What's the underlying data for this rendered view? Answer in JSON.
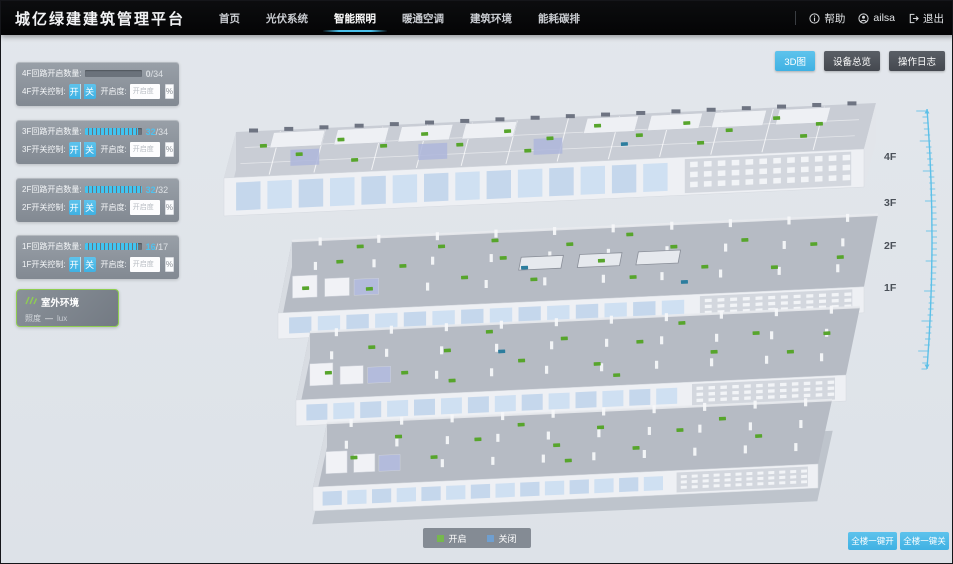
{
  "header": {
    "title": "城亿绿建建筑管理平台",
    "nav": [
      {
        "label": "首页",
        "active": false
      },
      {
        "label": "光伏系统",
        "active": false
      },
      {
        "label": "智能照明",
        "active": true
      },
      {
        "label": "暖通空调",
        "active": false
      },
      {
        "label": "建筑环境",
        "active": false
      },
      {
        "label": "能耗碳排",
        "active": false
      }
    ],
    "help": "帮助",
    "user": "ailsa",
    "logout": "退出"
  },
  "toolbar": {
    "view_3d": "3D图",
    "device_overview": "设备总览",
    "operation_log": "操作日志"
  },
  "floor_panels": [
    {
      "count_label": "4F回路开启数量:",
      "count": "0",
      "total": "/34",
      "progress_pct": 0,
      "count_color": "#d7dbdf",
      "switch_label": "4F开关控制:",
      "on_label": "开",
      "off_label": "关",
      "dim_label": "开启度:",
      "dim_placeholder": "开启度",
      "unit": "%"
    },
    {
      "count_label": "3F回路开启数量:",
      "count": "32",
      "total": "/34",
      "progress_pct": 94,
      "count_color": "#4fc1ee",
      "switch_label": "3F开关控制:",
      "on_label": "开",
      "off_label": "关",
      "dim_label": "开启度:",
      "dim_placeholder": "开启度",
      "unit": "%"
    },
    {
      "count_label": "2F回路开启数量:",
      "count": "32",
      "total": "/32",
      "progress_pct": 100,
      "count_color": "#4fc1ee",
      "switch_label": "2F开关控制:",
      "on_label": "开",
      "off_label": "关",
      "dim_label": "开启度:",
      "dim_placeholder": "开启度",
      "unit": "%"
    },
    {
      "count_label": "1F回路开启数量:",
      "count": "16",
      "total": "/17",
      "progress_pct": 94,
      "count_color": "#4fc1ee",
      "switch_label": "1F开关控制:",
      "on_label": "开",
      "off_label": "关",
      "dim_label": "开启度:",
      "dim_placeholder": "开启度",
      "unit": "%"
    }
  ],
  "outdoor": {
    "title": "室外环境",
    "metric_label": "照度",
    "metric_value": "—",
    "metric_unit": "lux"
  },
  "floor_labels": [
    "4F",
    "3F",
    "2F",
    "1F"
  ],
  "legend": {
    "on_label": "开启",
    "off_label": "关闭",
    "on_color": "#76b84e",
    "off_color": "#6f9fd0"
  },
  "bulk": {
    "all_on": "全楼一键开",
    "all_off": "全楼一键关"
  },
  "colors": {
    "accent": "#4db9e8",
    "navbar_bg": "#060607",
    "panel_bg": "#8b929b",
    "light_on": "#57a52c",
    "light_off": "#2c7d9e"
  }
}
